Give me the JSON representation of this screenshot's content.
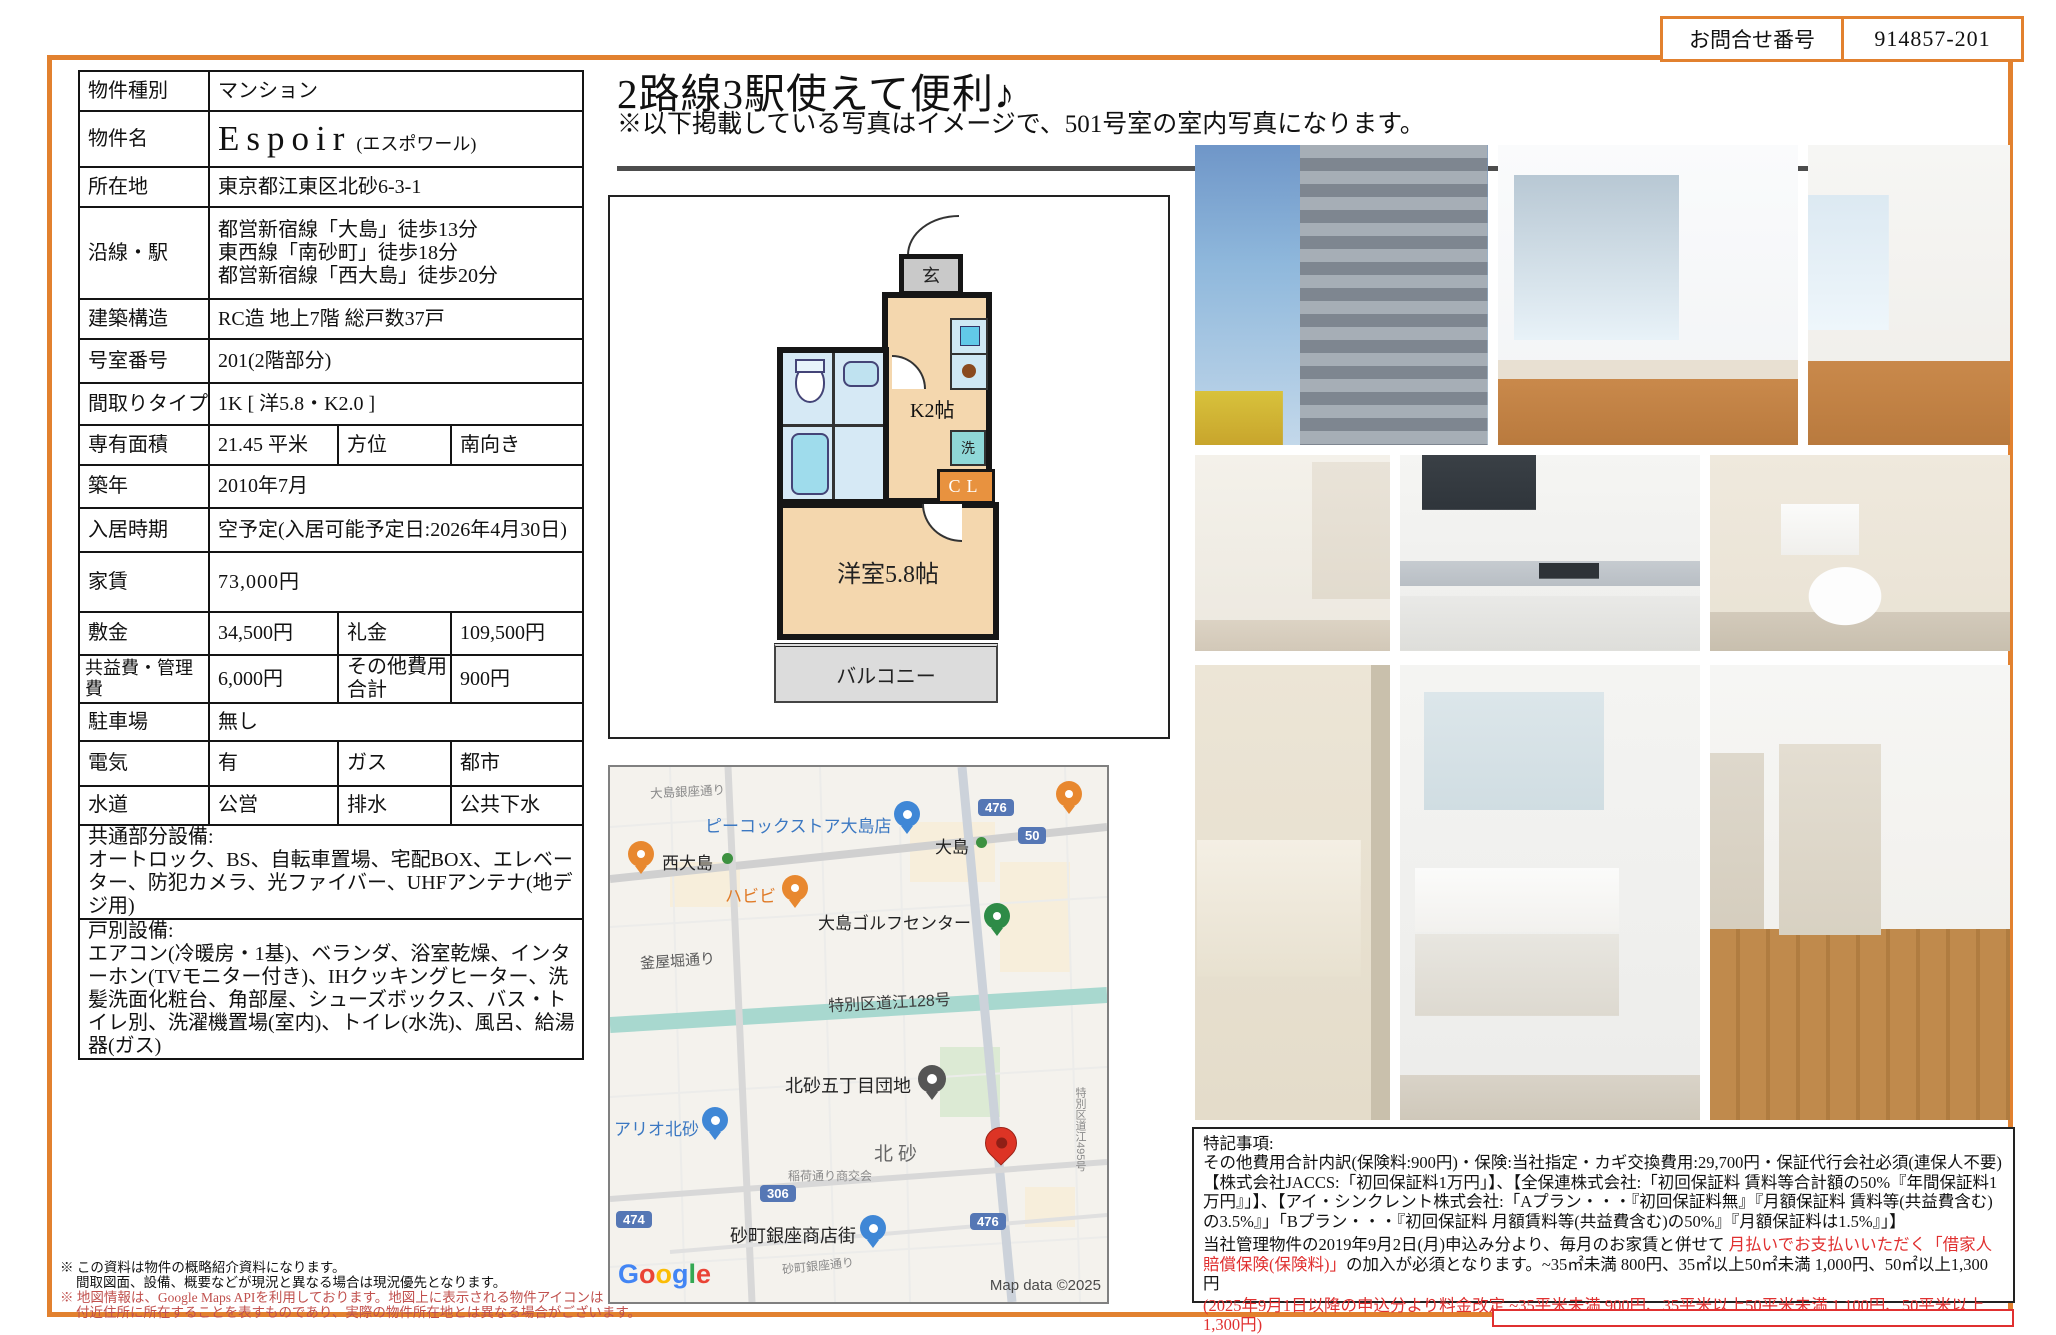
{
  "page": {
    "inquiry_label": "お問合せ番号",
    "inquiry_number": "914857-201",
    "accent_color": "#e2812f",
    "note_red": "#e03030",
    "footnote_red": "#c0504d"
  },
  "header": {
    "title": "2路線3駅使えて便利♪",
    "subtitle": "※以下掲載している写真はイメージで、501号室の室内写真になります。"
  },
  "table": {
    "r0": {
      "l": "物件種別",
      "v": "マンション"
    },
    "r1": {
      "l": "物件名",
      "en": "Espoir",
      "kana": "(エスポワール)"
    },
    "r2": {
      "l": "所在地",
      "v": "東京都江東区北砂6-3-1"
    },
    "r3": {
      "l": "沿線・駅",
      "v": "都営新宿線「大島」徒歩13分\n東西線「南砂町」徒歩18分\n都営新宿線「西大島」徒歩20分"
    },
    "r4": {
      "l": "建築構造",
      "v": "RC造 地上7階 総戸数37戸"
    },
    "r5": {
      "l": "号室番号",
      "v": "201(2階部分)"
    },
    "r6": {
      "l": "間取りタイプ",
      "v": "1K [ 洋5.8・K2.0 ]"
    },
    "r7": {
      "l": "専有面積",
      "v": "21.45 平米",
      "l2": "方位",
      "v2": "南向き"
    },
    "r8": {
      "l": "築年",
      "v": "2010年7月"
    },
    "r9": {
      "l": "入居時期",
      "v": "空予定(入居可能予定日:2026年4月30日)"
    },
    "r10": {
      "l": "家賃",
      "v": "73,000円"
    },
    "r11": {
      "l": "敷金",
      "v": "34,500円",
      "l2": "礼金",
      "v2": "109,500円"
    },
    "r12": {
      "l": "共益費・管理費",
      "v": "6,000円",
      "l2": "その他費用合計",
      "v2": "900円"
    },
    "r13": {
      "l": "駐車場",
      "v": "無し"
    },
    "r14": {
      "l": "電気",
      "v": "有",
      "l2": "ガス",
      "v2": "都市"
    },
    "r15": {
      "l": "水道",
      "v": "公営",
      "l2": "排水",
      "v2": "公共下水"
    },
    "r16": {
      "h": "共通部分設備:",
      "v": "オートロック、BS、自転車置場、宅配BOX、エレベーター、防犯カメラ、光ファイバー、UHFアンテナ(地デジ用)"
    },
    "r17": {
      "h": "戸別設備:",
      "v": "エアコン(冷暖房・1基)、ベランダ、浴室乾燥、インターホン(TVモニター付き)、IHクッキングヒーター、洗髪洗面化粧台、角部屋、シューズボックス、バス・トイレ別、洗濯機置場(室内)、トイレ(水洗)、風呂、給湯器(ガス)"
    }
  },
  "plan": {
    "genkan": "玄",
    "kitchen": "K2帖",
    "laundry": "洗",
    "closet": "CL",
    "room": "洋室5.8帖",
    "balcony": "バルコニー"
  },
  "map": {
    "streets": {
      "oshima_ginza": "大島銀座通り",
      "kamayabori": "釜屋堀通り",
      "tokubetsu128": "特別区道江128号",
      "kitasuna": "北砂",
      "inari": "稲荷通り商交会",
      "sunamachi_st": "砂町銀座通り",
      "tokubetsu495": "特別区道江495号"
    },
    "pois": {
      "peacock": "ピーコックストア大島店",
      "nishi_oshima": "西大島",
      "oshima": "大島",
      "habibi": "ハビビ",
      "golf": "大島ゴルフセンター",
      "danchi": "北砂五丁目団地",
      "ario": "アリオ北砂",
      "shotengai": "砂町銀座商店街"
    },
    "shields": {
      "r476": "476",
      "r50": "50",
      "r306": "306",
      "r474": "474",
      "r476b": "476"
    },
    "attribution": "Map data ©2025",
    "logo": [
      "G",
      "o",
      "o",
      "g",
      "l",
      "e"
    ]
  },
  "notes": {
    "heading": "特記事項:",
    "para1": "その他費用合計内訳(保険料:900円)・保険:当社指定・カギ交換費用:29,700円・保証代行会社必須(連保人不要)【株式会社JACCS:「初回保証料1万円」】、【全保連株式会社:「初回保証料 賃料等合計額の50%『年間保証料1万円』」】、【アイ・シンクレント株式会社:「Aプラン・・・『初回保証料無』『月額保証料 賃料等(共益費含む)の3.5%』」「Bプラン・・・『初回保証料 月額賃料等(共益費含む)の50%』『月額保証料は1.5%』」】",
    "para2_a": "当社管理物件の2019年9月2日(月)申込み分より、毎月のお家賃と併せて ",
    "para2_red": "月払いでお支払いいただく「借家人賠償保険(保険料)」",
    "para2_b": "の加入が必須となります。~35㎡未満 800円、35㎡以上50㎡未満 1,000円、50㎡以上1,300円",
    "para3_red": "(2025年9月1日以降の申込分より料金改定 ~35平米未満 900円、35平米以上50平米未満 1,100円、50平米以上1,300円)"
  },
  "footnotes": {
    "l1": "※ この資料は物件の概略紹介資料になります。",
    "l2": "間取図面、設備、概要などが現況と異なる場合は現況優先となります。",
    "l3": "※ 地図情報は、Google Maps APIを利用しております。地図上に表示される物件アイコンは",
    "l4": "付近住所に所在することを表すものであり、実際の物件所在地とは異なる場合がございます。"
  }
}
